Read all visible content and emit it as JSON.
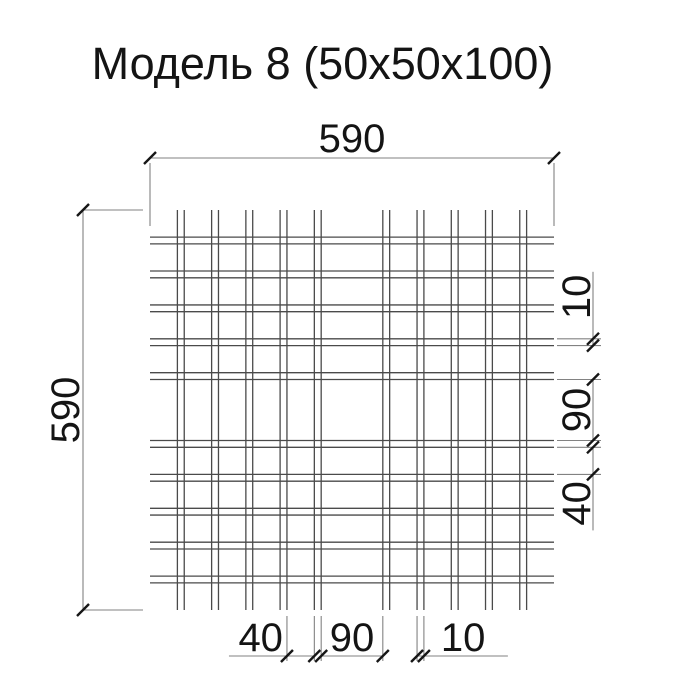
{
  "title": "Модель 8 (50х50х100)",
  "drawing": {
    "overall_size_units": 590,
    "wire_pair_twin_gap_units": 10,
    "wire_pair_pitch_units": 50,
    "clear_gap_units": 40,
    "middle_gap_units": 90,
    "edge_overhang_units": 40,
    "pair_start_positions_units": [
      40,
      90,
      140,
      190,
      240,
      340,
      390,
      440,
      490,
      540
    ],
    "dimensions": {
      "top": {
        "label": "590",
        "from_u": 0,
        "to_u": 590
      },
      "left": {
        "label": "590",
        "from_u": 0,
        "to_u": 590
      },
      "bottom": [
        {
          "label": "40",
          "from_u": 200,
          "to_u": 240,
          "text_pos": "outside-start"
        },
        {
          "label": "90",
          "from_u": 250,
          "to_u": 340,
          "text_pos": "center"
        },
        {
          "label": "10",
          "from_u": 390,
          "to_u": 400,
          "text_pos": "outside-end"
        }
      ],
      "right": [
        {
          "label": "10",
          "from_u": 190,
          "to_u": 200,
          "text_pos": "outside-start"
        },
        {
          "label": "90",
          "from_u": 250,
          "to_u": 340,
          "text_pos": "center"
        },
        {
          "label": "40",
          "from_u": 350,
          "to_u": 390,
          "text_pos": "outside-end"
        }
      ]
    }
  },
  "colors": {
    "wire": "#4a4a4a",
    "dimension_line": "#828282",
    "tick": "#161616",
    "text": "#141414",
    "background": "#ffffff"
  }
}
